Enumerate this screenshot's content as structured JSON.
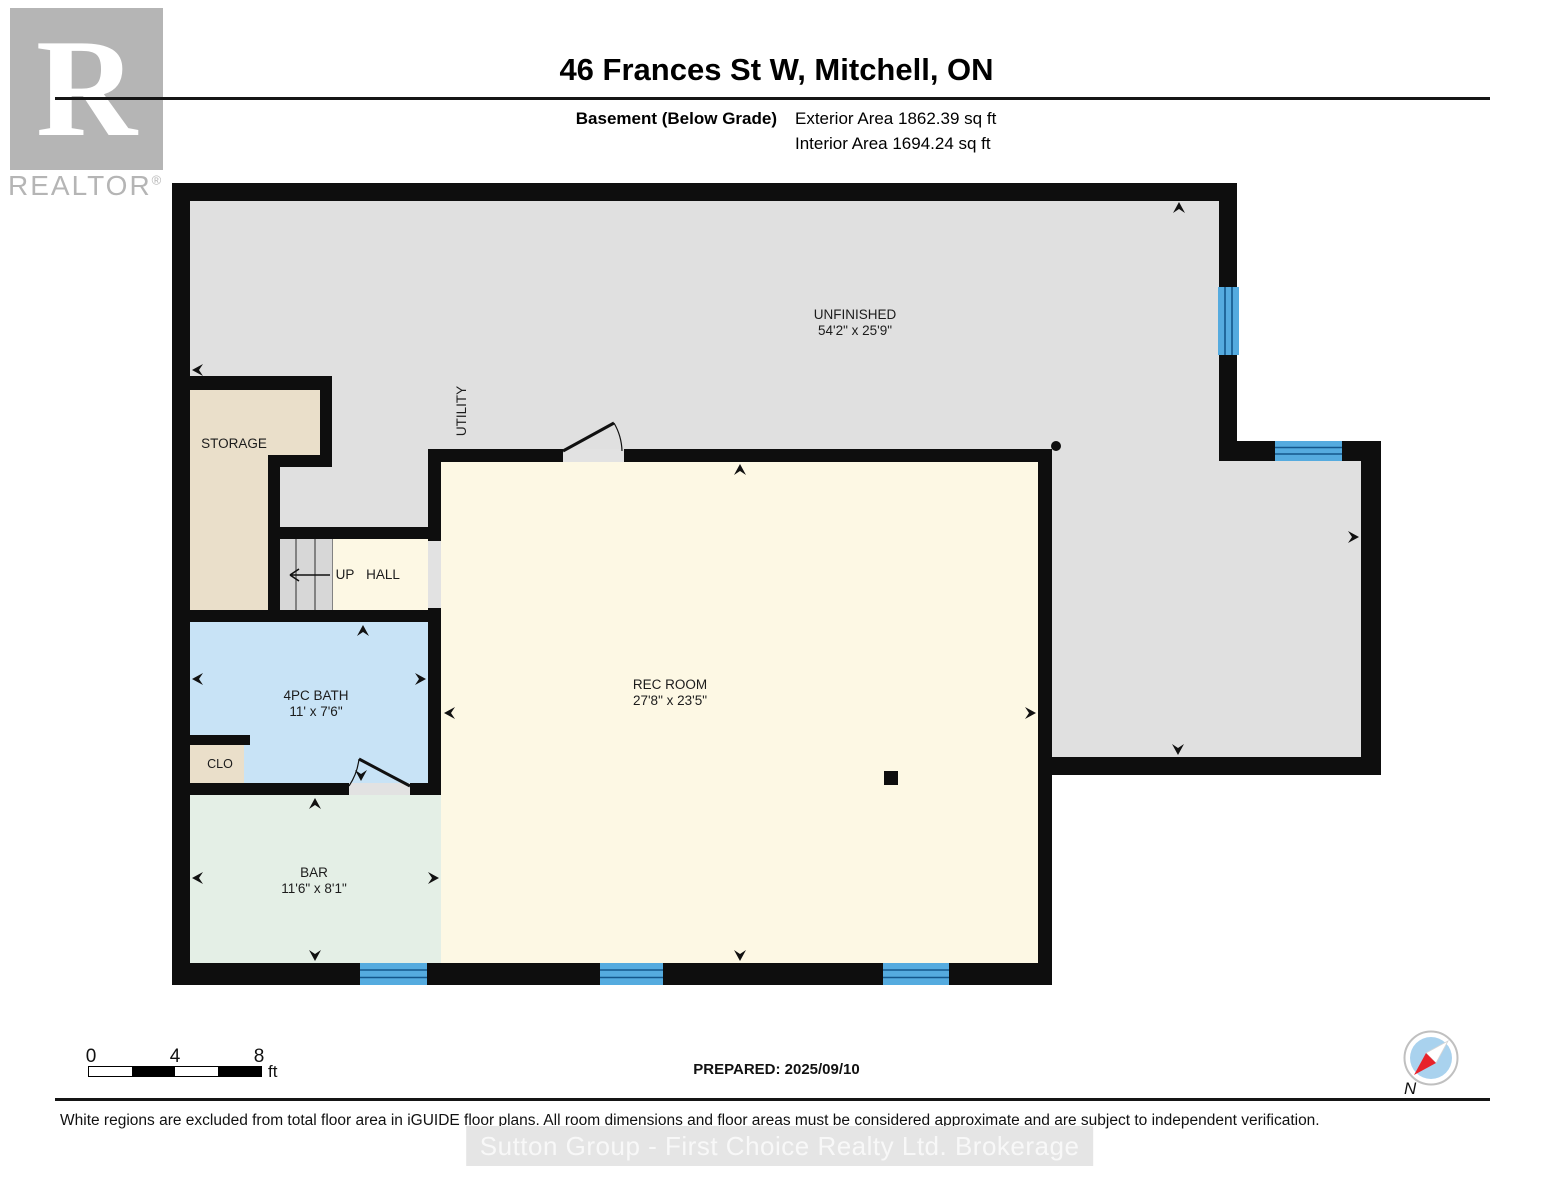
{
  "header": {
    "logo_letter": "R",
    "logo_brand": "REALTOR",
    "logo_reg": "®",
    "title": "46 Frances St W, Mitchell, ON",
    "floor_label": "Basement (Below Grade)",
    "exterior_area": "Exterior Area 1862.39 sq ft",
    "interior_area": "Interior Area 1694.24 sq ft"
  },
  "plan": {
    "rooms": {
      "unfinished": {
        "name": "UNFINISHED",
        "dims": "54'2\" x 25'9\""
      },
      "storage": {
        "name": "STORAGE"
      },
      "utility": {
        "name": "UTILITY"
      },
      "stairs": {
        "up": "UP",
        "hall": "HALL"
      },
      "bath": {
        "name": "4PC BATH",
        "dims": "11' x 7'6\""
      },
      "clo": {
        "name": "CLO"
      },
      "bar": {
        "name": "BAR",
        "dims": "11'6\" x 8'1\""
      },
      "rec": {
        "name": "REC ROOM",
        "dims": "27'8\" x 23'5\""
      }
    },
    "colors": {
      "wall": "#0e0e0e",
      "unfinished_floor": "#e0e0e0",
      "storage_floor": "#eadfca",
      "bath_floor": "#c8e3f6",
      "bar_floor": "#e4efe6",
      "rec_floor": "#fdf8e4",
      "stairs_floor": "#d7d7d7",
      "threshold": "#e2e2e2",
      "window_fill": "#55abdf",
      "window_line": "#14578c"
    }
  },
  "footer": {
    "scale_ticks": [
      "0",
      "4",
      "8"
    ],
    "scale_unit": "ft",
    "prepared": "PREPARED: 2025/09/10",
    "compass_north": "N",
    "disclaimer": "White regions are excluded from total floor area in iGUIDE floor plans. All room dimensions and floor areas must be considered approximate and are subject to independent verification.",
    "watermark": "Sutton Group - First Choice Realty Ltd.  Brokerage"
  }
}
